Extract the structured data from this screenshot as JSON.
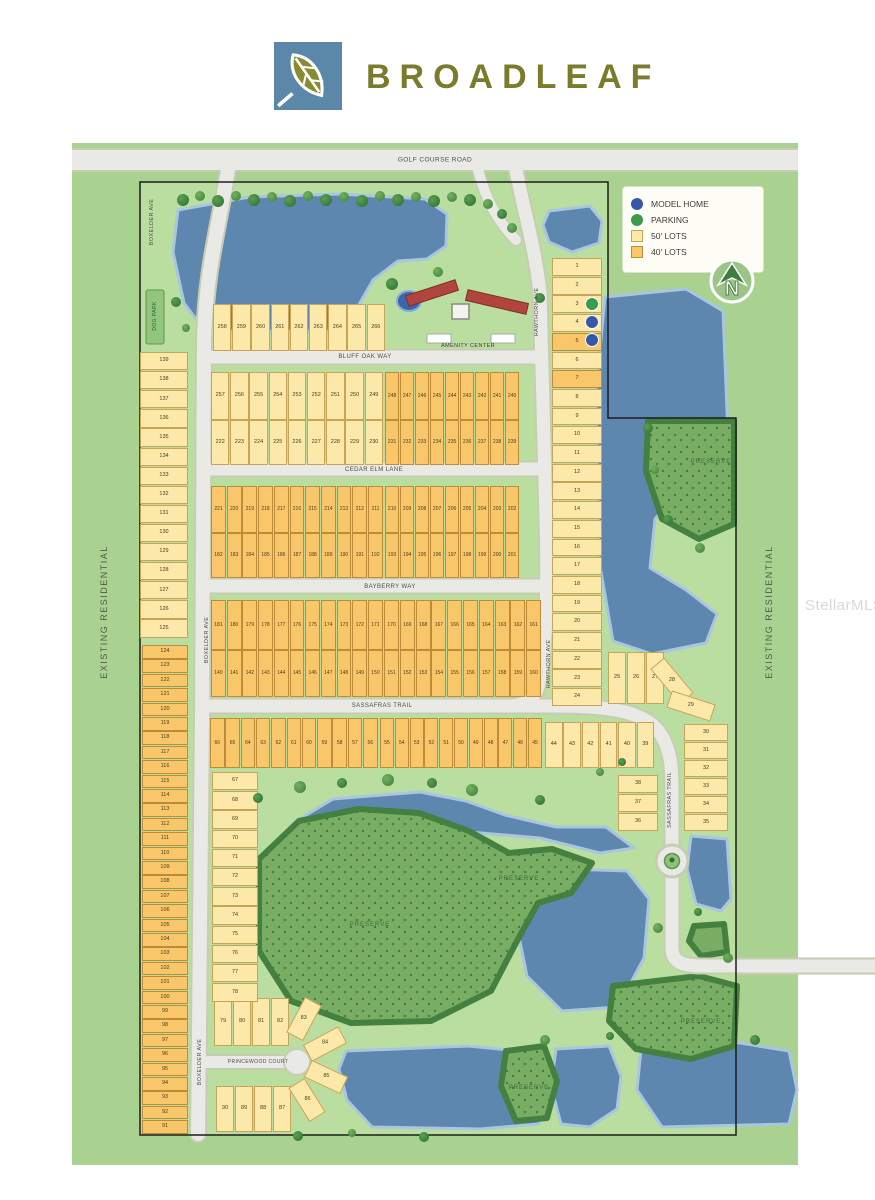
{
  "header": {
    "brand": "BROADLEAF"
  },
  "watermark": {
    "text": "StellarMLS"
  },
  "legend": {
    "items": [
      {
        "type": "model",
        "label": "MODEL HOME"
      },
      {
        "type": "parking",
        "label": "PARKING"
      },
      {
        "type": "lot50",
        "label": "50' LOTS"
      },
      {
        "type": "lot40",
        "label": "40' LOTS"
      }
    ],
    "north_label": "N"
  },
  "colors": {
    "model_home": "#3757a8",
    "parking": "#3d9b4f",
    "lot50": "#fce8a9",
    "lot40": "#f9c76a",
    "lake": "#5d87ae",
    "preserve": "#79ad63",
    "parcel": "#bade9f",
    "outer_green": "#a9d290"
  },
  "labels": [
    {
      "text": "GOLF COURSE ROAD",
      "x": 435,
      "y": 160,
      "size": 6.5
    },
    {
      "text": "BOXELDER AVE",
      "x": 152,
      "y": 222,
      "rot": -90,
      "size": 5.5
    },
    {
      "text": "BOXELDER AVE",
      "x": 207,
      "y": 640,
      "rot": -90,
      "size": 5.5
    },
    {
      "text": "BOXELDER AVE",
      "x": 200,
      "y": 1062,
      "rot": -90,
      "size": 5.5
    },
    {
      "text": "HAWTHORN AVE",
      "x": 537,
      "y": 312,
      "rot": -90,
      "size": 5.5
    },
    {
      "text": "HAWTHORN AVE",
      "x": 549,
      "y": 664,
      "rot": -90,
      "size": 5.5
    },
    {
      "text": "BLUFF OAK WAY",
      "x": 365,
      "y": 357,
      "size": 6
    },
    {
      "text": "CEDAR ELM LANE",
      "x": 374,
      "y": 470,
      "size": 6
    },
    {
      "text": "BAYBERRY WAY",
      "x": 390,
      "y": 587,
      "size": 6
    },
    {
      "text": "SASSAFRAS TRAIL",
      "x": 382,
      "y": 706,
      "size": 6
    },
    {
      "text": "SASSAFRAS TRAIL",
      "x": 670,
      "y": 800,
      "rot": -90,
      "size": 5.5
    },
    {
      "text": "PRINCEWOOD COURT",
      "x": 258,
      "y": 1062,
      "size": 5
    },
    {
      "text": "AMENITY CENTER",
      "x": 468,
      "y": 346,
      "size": 5.5,
      "color": "#3d3d35"
    },
    {
      "text": "DOG PARK",
      "x": 155,
      "y": 316,
      "rot": -90,
      "size": 5,
      "color": "#2f5c2c"
    },
    {
      "text": "PRESERVE",
      "x": 711,
      "y": 462,
      "size": 6,
      "color": "#3f6b40",
      "ls": 1
    },
    {
      "text": "PRESERVE",
      "x": 370,
      "y": 925,
      "size": 6,
      "color": "#3f6b40",
      "ls": 1
    },
    {
      "text": "PRESERVE",
      "x": 519,
      "y": 879,
      "size": 6,
      "color": "#3f6b40",
      "ls": 1
    },
    {
      "text": "PRESERVE",
      "x": 529,
      "y": 1088,
      "size": 6,
      "color": "#3f6b40",
      "ls": 1
    },
    {
      "text": "PRESERVE",
      "x": 701,
      "y": 1022,
      "size": 6,
      "color": "#3f6b40",
      "ls": 1
    },
    {
      "text": "EXISTING RESIDENTIAL",
      "x": 104,
      "y": 612,
      "rot": -90,
      "size": 9,
      "color": "#4f5b4d",
      "ls": 1.5
    },
    {
      "text": "EXISTING RESIDENTIAL",
      "x": 769,
      "y": 612,
      "rot": -90,
      "size": 9,
      "color": "#4f5b4d",
      "ls": 1.5
    }
  ],
  "lots": {
    "h_groups": [
      {
        "x": 213,
        "y": 304,
        "w": 19.2,
        "h": 47,
        "type": "50",
        "nums": [
          258,
          259,
          260,
          261,
          262,
          263,
          264,
          265,
          266
        ]
      },
      {
        "x": 211,
        "y": 372,
        "w": 19.2,
        "h": 48,
        "type": "50",
        "nums": [
          257,
          256,
          255,
          254,
          253,
          252,
          251,
          250,
          249
        ]
      },
      {
        "x": 385,
        "y": 372,
        "w": 15.0,
        "h": 48,
        "type": "40",
        "nums": [
          248,
          247,
          246,
          245,
          244,
          243,
          242,
          241,
          240
        ]
      },
      {
        "x": 211,
        "y": 420,
        "w": 19.2,
        "h": 45,
        "type": "50",
        "nums": [
          222,
          223,
          224,
          225,
          226,
          227,
          228,
          229,
          230
        ]
      },
      {
        "x": 385,
        "y": 420,
        "w": 15.0,
        "h": 45,
        "type": "40",
        "nums": [
          231,
          232,
          233,
          234,
          235,
          236,
          237,
          238,
          239
        ]
      },
      {
        "x": 211,
        "y": 486,
        "w": 15.7,
        "h": 47,
        "type": "40",
        "nums": [
          221,
          220,
          219,
          218,
          217,
          216,
          215,
          214,
          213,
          212,
          211
        ]
      },
      {
        "x": 385,
        "y": 486,
        "w": 15.0,
        "h": 47,
        "type": "40",
        "nums": [
          210,
          209,
          208,
          207,
          206,
          205,
          204,
          203,
          202
        ]
      },
      {
        "x": 211,
        "y": 533,
        "w": 15.7,
        "h": 45,
        "type": "40",
        "nums": [
          182,
          183,
          184,
          185,
          186,
          187,
          188,
          189,
          190,
          191,
          192
        ]
      },
      {
        "x": 385,
        "y": 533,
        "w": 15.0,
        "h": 45,
        "type": "40",
        "nums": [
          193,
          194,
          195,
          196,
          197,
          198,
          199,
          200,
          201
        ]
      },
      {
        "x": 211,
        "y": 600,
        "w": 15.7,
        "h": 50,
        "type": "40",
        "nums": [
          181,
          180,
          179,
          178,
          177,
          176,
          175,
          174,
          173,
          172,
          171
        ]
      },
      {
        "x": 384,
        "y": 600,
        "w": 15.8,
        "h": 50,
        "type": "40",
        "nums": [
          170,
          169,
          168,
          167,
          166,
          165,
          164,
          163,
          162,
          161
        ]
      },
      {
        "x": 211,
        "y": 650,
        "w": 15.7,
        "h": 47,
        "type": "40",
        "nums": [
          140,
          141,
          142,
          143,
          144,
          145,
          146,
          147,
          148,
          149,
          150
        ]
      },
      {
        "x": 384,
        "y": 650,
        "w": 15.8,
        "h": 47,
        "type": "40",
        "nums": [
          151,
          152,
          153,
          154,
          155,
          156,
          157,
          158,
          159,
          160
        ]
      },
      {
        "x": 210,
        "y": 718,
        "w": 15.3,
        "h": 50,
        "type": "40",
        "nums": [
          66,
          65,
          64,
          63,
          62,
          61,
          60,
          59,
          58,
          57,
          56
        ]
      },
      {
        "x": 380,
        "y": 718,
        "w": 14.8,
        "h": 50,
        "type": "40",
        "nums": [
          55,
          54,
          53,
          52,
          51,
          50,
          49,
          48,
          47,
          46,
          45
        ]
      },
      {
        "x": 545,
        "y": 722,
        "w": 18.3,
        "h": 46,
        "type": "50",
        "nums": [
          44,
          43,
          42,
          41,
          40,
          39
        ]
      },
      {
        "x": 608,
        "y": 652,
        "w": 19.0,
        "h": 52,
        "type": "50",
        "nums": [
          25,
          26,
          27
        ]
      },
      {
        "x": 214,
        "y": 998,
        "w": 19.0,
        "h": 48,
        "type": "50",
        "nums": [
          79,
          80,
          81,
          82
        ]
      },
      {
        "x": 216,
        "y": 1086,
        "w": 19.0,
        "h": 46,
        "type": "50",
        "nums": [
          90,
          89,
          88,
          87
        ]
      }
    ],
    "v_groups": [
      {
        "x": 552,
        "y": 258,
        "w": 50,
        "h": 18.7,
        "type": "50",
        "orange": [
          5,
          7
        ],
        "nums": [
          1,
          2,
          3,
          4,
          5,
          6,
          7,
          8,
          9,
          10,
          11,
          12,
          13,
          14,
          15,
          16,
          17,
          18,
          19,
          20,
          21,
          22,
          23,
          24
        ]
      },
      {
        "x": 684,
        "y": 724,
        "w": 44,
        "h": 18,
        "type": "50",
        "nums": [
          30,
          31,
          32,
          33,
          34,
          35
        ]
      },
      {
        "x": 618,
        "y": 775,
        "w": 40,
        "h": 19,
        "type": "50",
        "nums": [
          38,
          37,
          36
        ]
      },
      {
        "x": 140,
        "y": 352,
        "w": 48,
        "h": 19.1,
        "type": "50",
        "nums": [
          139,
          138,
          137,
          136,
          135,
          134,
          133,
          132,
          131,
          130,
          129,
          128,
          127,
          126,
          125
        ]
      },
      {
        "x": 142,
        "y": 645,
        "w": 46,
        "h": 14.4,
        "type": "40",
        "nums": [
          124,
          123,
          122,
          121,
          120,
          119,
          118,
          117,
          116,
          115,
          114,
          113,
          112,
          111,
          110,
          109,
          108,
          107,
          106,
          105,
          104,
          103,
          102,
          101,
          100,
          99,
          98,
          97,
          96,
          95,
          94,
          93,
          92,
          91
        ]
      },
      {
        "x": 212,
        "y": 772,
        "w": 46,
        "h": 19.2,
        "type": "50",
        "nums": [
          67,
          68,
          69,
          70,
          71,
          72,
          73,
          74,
          75,
          76,
          77,
          78
        ]
      }
    ],
    "singles": [
      {
        "num": 28,
        "cx": 672,
        "cy": 681,
        "w": 18,
        "h": 46,
        "rot": -40,
        "type": "50"
      },
      {
        "num": 29,
        "cx": 691,
        "cy": 706,
        "w": 18,
        "h": 46,
        "rot": -72,
        "type": "50"
      },
      {
        "num": 83,
        "cx": 304,
        "cy": 1019,
        "w": 19,
        "h": 40,
        "rot": 28,
        "type": "50"
      },
      {
        "num": 84,
        "cx": 325,
        "cy": 1044,
        "w": 19,
        "h": 40,
        "rot": 62,
        "type": "50"
      },
      {
        "num": 85,
        "cx": 326,
        "cy": 1077,
        "w": 19,
        "h": 40,
        "rot": 115,
        "type": "50"
      },
      {
        "num": 86,
        "cx": 307,
        "cy": 1100,
        "w": 19,
        "h": 40,
        "rot": 148,
        "type": "50"
      }
    ]
  },
  "markers": [
    {
      "x": 592,
      "y": 304,
      "type": "parking",
      "lot": 3
    },
    {
      "x": 592,
      "y": 322,
      "type": "model",
      "lot": 4
    },
    {
      "x": 592,
      "y": 340,
      "type": "model",
      "lot": 5
    }
  ],
  "trees": [
    [
      183,
      200,
      6,
      0
    ],
    [
      200,
      196,
      5,
      1
    ],
    [
      218,
      201,
      6,
      0
    ],
    [
      236,
      196,
      5,
      1
    ],
    [
      254,
      200,
      6,
      0
    ],
    [
      272,
      197,
      5,
      1
    ],
    [
      290,
      201,
      6,
      0
    ],
    [
      308,
      196,
      5,
      1
    ],
    [
      326,
      200,
      6,
      0
    ],
    [
      344,
      197,
      5,
      1
    ],
    [
      362,
      201,
      6,
      0
    ],
    [
      380,
      196,
      5,
      1
    ],
    [
      398,
      200,
      6,
      0
    ],
    [
      416,
      197,
      5,
      1
    ],
    [
      434,
      201,
      6,
      0
    ],
    [
      452,
      197,
      5,
      1
    ],
    [
      470,
      200,
      6,
      0
    ],
    [
      488,
      204,
      5,
      1
    ],
    [
      502,
      214,
      5,
      0
    ],
    [
      512,
      228,
      5,
      1
    ],
    [
      392,
      284,
      6,
      0
    ],
    [
      438,
      272,
      5,
      1
    ],
    [
      540,
      298,
      5,
      0
    ],
    [
      648,
      428,
      5,
      0
    ],
    [
      655,
      470,
      4,
      1
    ],
    [
      668,
      520,
      5,
      0
    ],
    [
      700,
      548,
      5,
      1
    ],
    [
      258,
      798,
      5,
      0
    ],
    [
      300,
      787,
      6,
      1
    ],
    [
      342,
      783,
      5,
      0
    ],
    [
      388,
      780,
      6,
      1
    ],
    [
      432,
      783,
      5,
      0
    ],
    [
      472,
      790,
      6,
      1
    ],
    [
      540,
      800,
      5,
      0
    ],
    [
      298,
      1136,
      5,
      0
    ],
    [
      352,
      1133,
      4,
      1
    ],
    [
      424,
      1137,
      5,
      0
    ],
    [
      545,
      1040,
      5,
      1
    ],
    [
      610,
      1036,
      4,
      0
    ],
    [
      658,
      928,
      5,
      1
    ],
    [
      698,
      912,
      4,
      0
    ],
    [
      728,
      958,
      5,
      1
    ],
    [
      755,
      1040,
      5,
      0
    ],
    [
      600,
      772,
      4,
      1
    ],
    [
      622,
      762,
      4,
      0
    ],
    [
      176,
      302,
      5,
      0
    ],
    [
      186,
      328,
      4,
      1
    ]
  ]
}
